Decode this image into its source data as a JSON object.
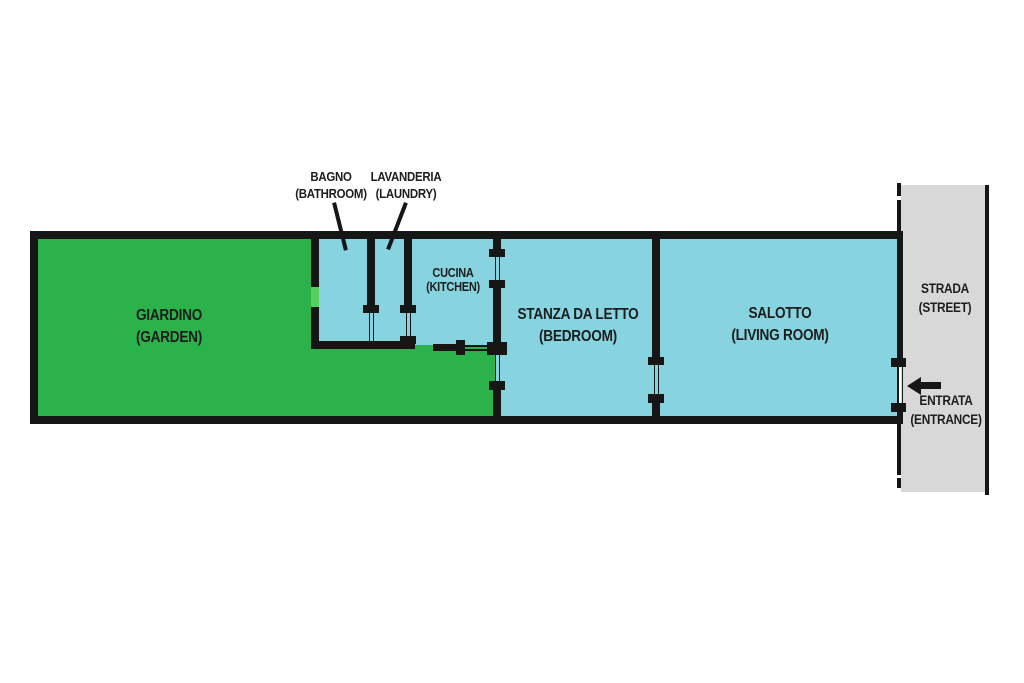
{
  "diagram": {
    "type": "floor-plan",
    "language": "Italian with English translations",
    "rooms": [
      {
        "id": "giardino",
        "name": "GIARDINO",
        "name_en": "(GARDEN)",
        "fill": "garden"
      },
      {
        "id": "bagno",
        "name": "BAGNO",
        "name_en": "(BATHROOM)",
        "fill": "room"
      },
      {
        "id": "lavanderia",
        "name": "LAVANDERIA",
        "name_en": "(LAUNDRY)",
        "fill": "room"
      },
      {
        "id": "cucina",
        "name": "CUCINA",
        "name_en": "(KITCHEN)",
        "fill": "room"
      },
      {
        "id": "stanza_da_letto",
        "name": "STANZA DA LETTO",
        "name_en": "(BEDROOM)",
        "fill": "room"
      },
      {
        "id": "salotto",
        "name": "SALOTTO",
        "name_en": "(LIVING ROOM)",
        "fill": "room"
      },
      {
        "id": "strada",
        "name": "STRADA",
        "name_en": "(STREET)",
        "fill": "street"
      },
      {
        "id": "entrata",
        "name": "ENTRATA",
        "name_en": "(ENTRANCE)",
        "fill": "none"
      }
    ],
    "icons": {
      "entrance_arrow_direction": "left"
    },
    "colors": {
      "garden": "#2bb24a",
      "garden_door": "#58cf5f",
      "room": "#87d4e0",
      "street": "#d8d8d8",
      "wall": "#161616",
      "bg": "#ffffff",
      "text": "#1d1d1d"
    }
  }
}
